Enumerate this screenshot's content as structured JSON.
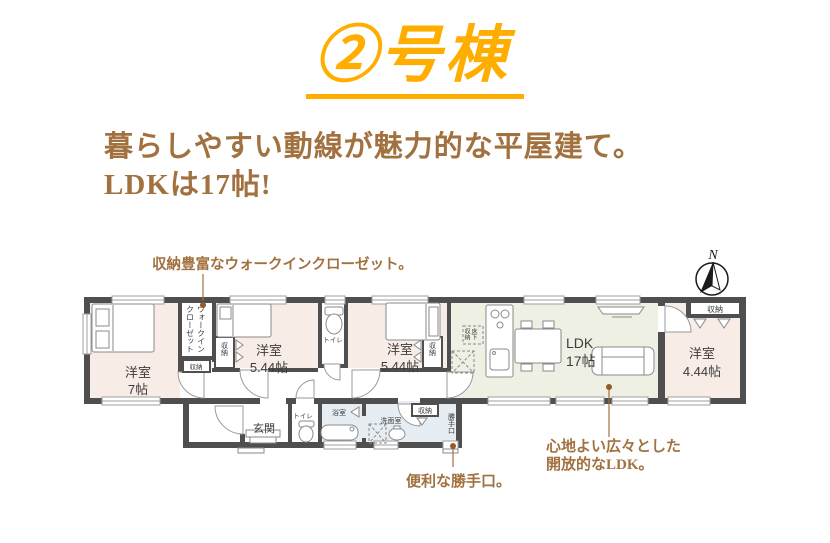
{
  "title": "②号棟",
  "headline": {
    "line1": "暮らしやすい動線が魅力的な平屋建て。",
    "line2": "LDKは17帖!"
  },
  "compass": {
    "north": "N"
  },
  "annotations": {
    "wic": "収納豊富なウォークインクローゼット。",
    "ldk1": "心地よい広々とした",
    "ldk2": "開放的なLDK。",
    "backdoor": "便利な勝手口。"
  },
  "rooms": {
    "west7": {
      "name": "洋室",
      "size": "7帖"
    },
    "west544a": {
      "name": "洋室",
      "size": "5.44帖"
    },
    "west544b": {
      "name": "洋室",
      "size": "5.44帖"
    },
    "west444": {
      "name": "洋室",
      "size": "4.44帖"
    },
    "ldk": {
      "name": "LDK",
      "size": "17帖"
    },
    "entrance": "玄関",
    "toilet": "トイレ",
    "bath": "浴室",
    "washroom": "洗面室",
    "wic_right": "ウォークイン",
    "wic_left": "クローゼット",
    "storage": "収納",
    "backdoor": "勝手口",
    "underfloor_r": "床下",
    "underfloor_l": "収納"
  },
  "colors": {
    "title_yellow": "#FFAE00",
    "text_brown": "#A1713F",
    "wall_gray": "#4F4F4F",
    "bedroom_pink": "#F8ECE7",
    "ldk_green": "#EEF0E4",
    "bath_blue": "#E7EEF3"
  }
}
